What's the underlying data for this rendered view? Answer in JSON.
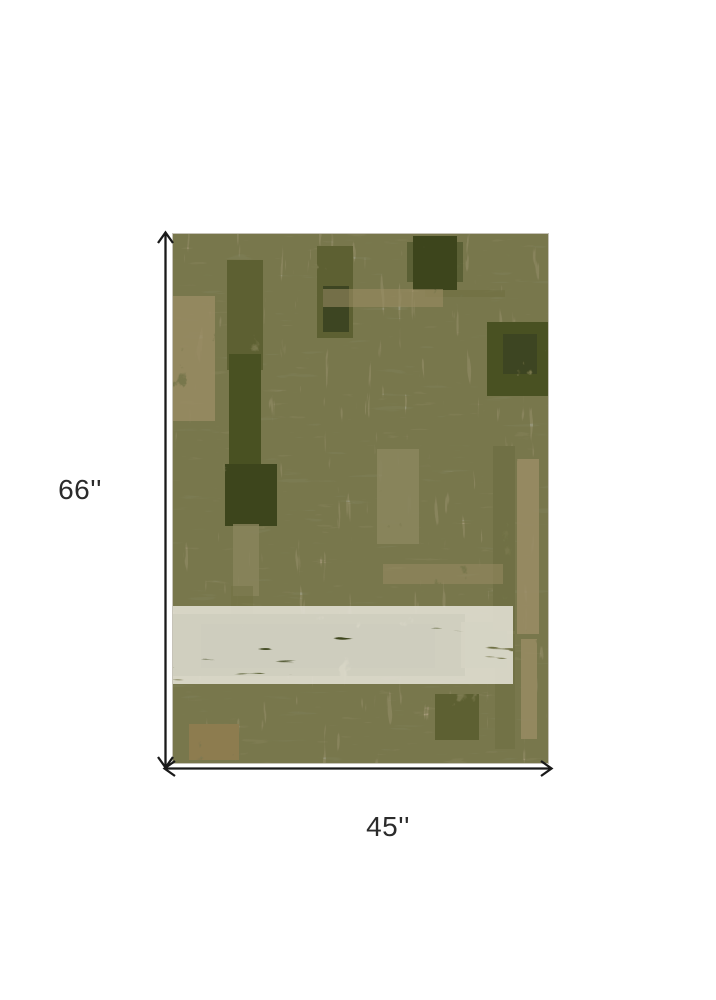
{
  "page": {
    "background": "#ffffff"
  },
  "diagram": {
    "height_label": "66''",
    "width_label": "45''",
    "arrow_color": "#1a1a1a",
    "label_color": "#2b2b2b"
  },
  "rug": {
    "palette": {
      "base": "#e8e5db",
      "gray_patch": "#d3d7da",
      "gray_patch_light": "#dadde0",
      "grain": "#b5ae9c",
      "tan_scratch": "#a29470",
      "olive_scratch": "#75744a",
      "olive_deep": "#3c441d",
      "olive_dark": "#3e4520",
      "olive": "#4a5124",
      "olive_mid": "#5d6032",
      "olive_soft": "#6f7044",
      "olive_brown": "#6f6640",
      "khaki": "#8a855c",
      "tan": "#9a8c64",
      "brown": "#8d7b50",
      "edge": "#c6c3b8"
    }
  }
}
